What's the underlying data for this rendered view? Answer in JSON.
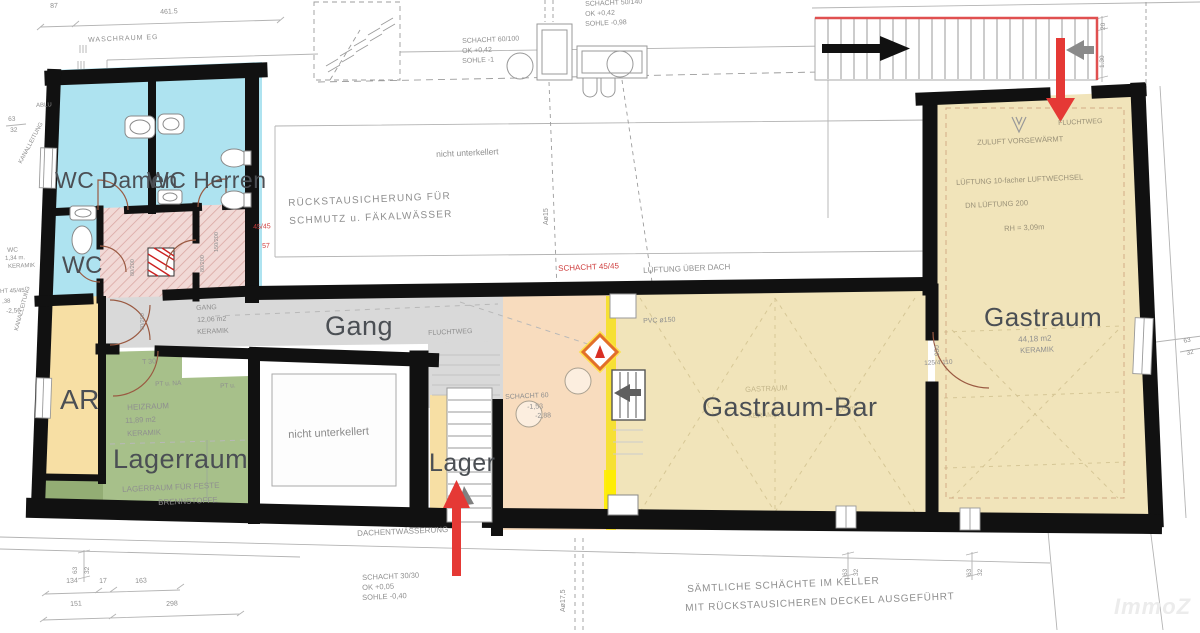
{
  "rooms": {
    "wc_damen": "WC Damen",
    "wc_herren": "WC Herren",
    "wc": "WC",
    "ar": "AR",
    "lagerraum": "Lagerraum",
    "gang": "Gang",
    "lager": "Lager",
    "gastraum_bar": "Gastraum-Bar",
    "gastraum": "Gastraum"
  },
  "ann": {
    "d87": "87",
    "d461": "461.5",
    "waschraum": "WASCHRAUM EG",
    "schacht50": "SCHACHT 50/140",
    "ok042": "OK +0,42",
    "sohle098": "SOHLE -0,98",
    "schacht60_100": "SCHACHT 60/100",
    "sohle1": "SOHLE -1",
    "nicht_unterkellert": "nicht unterkellert",
    "rueckstau1": "RÜCKSTAUSICHERUNG FÜR",
    "rueckstau2": "SCHMUTZ u. FÄKALWÄSSER",
    "schacht45": "SCHACHT 45/45",
    "lueftung_dach": "LÜFTUNG ÜBER DACH",
    "red4545": "45/45",
    "red57": "57",
    "gang_name": "GANG",
    "gang_area": "12,06 m2",
    "keramik": "KERAMIK",
    "fluchtweg": "FLUCHTWEG",
    "t30": "T 30",
    "pt_na": "PT u. NA",
    "pt_u": "PT u.",
    "heizraum": "HEIZRAUM",
    "heiz_area": "11,89 m2",
    "lager_feste1": "LAGERRAUM FÜR FESTE",
    "lager_feste2": "BRENNSTOFFE",
    "schacht60": "SCHACHT 60",
    "m153": "-1,53",
    "m288": "-2,88",
    "pvc": "PVC ø150",
    "gastraum_small": "GASTRAUM",
    "rh300": "3,00m",
    "zuluft": "ZULUFT VORGEWÄRMT",
    "lueftung10": "LÜFTUNG 10-facher LUFTWECHSEL",
    "dn200": "DN LÜFTUNG 200",
    "rh309": "RH = 3,09m",
    "gast_area": "44,18 m2",
    "d950": "950",
    "d125": "125/4 110",
    "dim20": "20",
    "dim130": "1.30",
    "dachent": "DACHENTWÄSSERUNG",
    "schacht30": "SCHACHT 30/30",
    "ok005": "OK +0,05",
    "sohle040": "SOHLE -0,40",
    "a15": "Aø15",
    "a175": "Aø17,5",
    "ablu": "ABLU",
    "wc_small": "WC",
    "wc_area": "1,34 m.",
    "ht4545": "HT 45/45",
    "m138": ",38",
    "m256": "-2,56",
    "leitung": "KANALLEITUNG",
    "d63": "63",
    "d32": "32",
    "d134": "134",
    "d17": "17",
    "d163": "163",
    "d151": "151",
    "d298": "298",
    "saemtliche1": "SÄMTLICHE SCHÄCHTE IM KELLER",
    "saemtliche2": "MIT RÜCKSTAUSICHEREN DECKEL AUSGEFÜHRT",
    "door80": "80/200",
    "door150": "150/200"
  },
  "colors": {
    "wall": "#111111",
    "wet_room": "#aee3f0",
    "vestibule": "#f1d9d6",
    "room_tan": "#f1e4ba",
    "room_peach": "#f8dcbe",
    "room_orange": "#f7dfa4",
    "room_green": "#a7c08a",
    "corridor": "#d9d9d9",
    "escape_red": "#e53935",
    "stair_red": "#e05050",
    "warning_orange": "#e2702a",
    "hazard_yellow": "#f6e11c"
  },
  "watermark": "ImmoZ"
}
